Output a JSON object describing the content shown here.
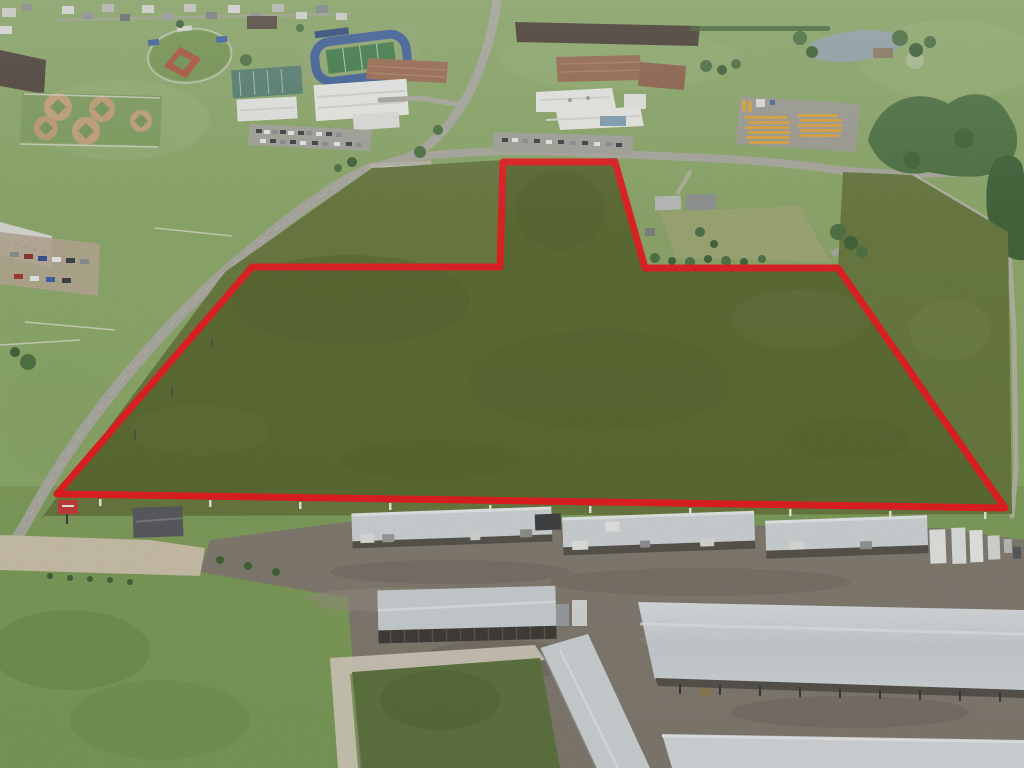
{
  "scene": {
    "type": "aerial-drone-photo",
    "description": "Aerial drone photograph of a vacant grass land parcel outlined with a thick red property boundary. North (top) shows a school campus with football stadium, baseball and softball fields, brick school buildings, parking lots and a yellow school-bus lot, plus a pond and tree lines. A two-lane road runs diagonally along the parcel's west edge. South (bottom) shows an RV/boat storage facility with long gray-roofed canopies and buildings on gravel. A farmhouse with lawn sits in a notch excluded from the parcel on the east side.",
    "areas": [
      "residential-strip",
      "baseball-field",
      "softball-complex",
      "football-stadium",
      "practice-field",
      "school-buildings",
      "parking-lots",
      "bus-lot",
      "pond",
      "tree-line",
      "highway",
      "gas-station",
      "farmhouse-notch",
      "land-parcel",
      "storage-facility",
      "office-building",
      "lawn"
    ]
  },
  "colors": {
    "boundary_red": "#e21b1e",
    "parcel_grass": "#59692f",
    "crop_green": "#66773c",
    "field_light": "#8aa767",
    "field_low": "#7d9b58",
    "road_gray": "#a8a89e",
    "gravel": "#80796e",
    "concrete": "#c9bfa8",
    "roof_white": "#e9eae6",
    "canopy_gray": "#cdd2d4",
    "brick": "#9a6a50",
    "water": "#93a3a8",
    "plowed_dark": "#4b4037",
    "bus_yellow": "#d9a23d",
    "infield_red": "#aa5339",
    "infield_tan": "#c2a077",
    "track_blue": "#3d5f98",
    "sign_red": "#c03a38",
    "farm_lawn": "#8ba567"
  },
  "parcel": {
    "boundary_points": "503,162 615,162 645,268 838,268 1005,508 57,494 252,267 500,267",
    "stroke_width": 7,
    "fill": "#59692f"
  },
  "crop_field": {
    "points": "40,520 225,272 372,168 503,160 617,158 648,268 838,268 843,172 912,175 1008,232 1012,514 44,516",
    "fill": "#66773c"
  },
  "farm_lawn_points": "618,196 800,190 838,266 648,266",
  "pond": {
    "fill": "#93a3a8"
  }
}
